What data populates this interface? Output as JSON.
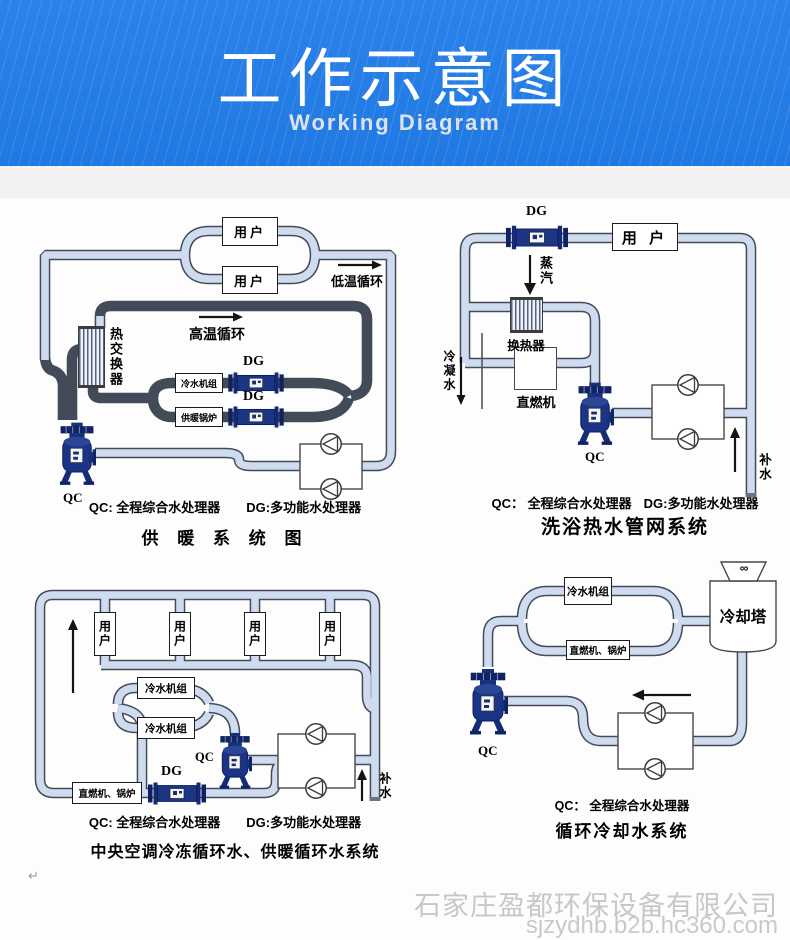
{
  "header": {
    "title": "工作示意图",
    "subtitle": "Working Diagram"
  },
  "colors": {
    "header_blue": "#2b82ea",
    "pipe_fill": "#cfdcf0",
    "pipe_outline": "#434b59",
    "device_navy": "#1b3488"
  },
  "d1": {
    "title": "供 暖 系 统 图",
    "legend_qc": "QC: 全程综合水处理器",
    "legend_dg": "DG:多功能水处理器",
    "labels": {
      "user1": "用户",
      "user2": "用户",
      "low_temp": "低温循环",
      "high_temp": "高温循环",
      "heat_exchanger": "热交换器",
      "chiller": "冷水机组",
      "boiler": "供暖锅炉",
      "dg1": "DG",
      "dg2": "DG",
      "qc": "QC"
    }
  },
  "d2": {
    "title": "洗浴热水管网系统",
    "legend_qc": "QC： 全程综合水处理器",
    "legend_dg": "DG:多功能水处理器",
    "labels": {
      "dg": "DG",
      "user": "用 户",
      "steam": "蒸汽",
      "exchanger": "换热器",
      "direct_fired": "直燃机",
      "condensate": "冷凝水",
      "qc": "QC",
      "makeup": "补水"
    }
  },
  "d3": {
    "title": "中央空调冷冻循环水、供暖循环水系统",
    "legend_qc": "QC: 全程综合水处理器",
    "legend_dg": "DG:多功能水处理器",
    "labels": {
      "users": [
        "用户",
        "用户",
        "用户",
        "用户"
      ],
      "chiller1": "冷水机组",
      "chiller2": "冷水机组",
      "boiler": "直燃机、锅炉",
      "dg": "DG",
      "qc": "QC",
      "makeup": "补水"
    }
  },
  "d4": {
    "title": "循环冷却水系统",
    "legend_qc": "QC： 全程综合水处理器",
    "labels": {
      "chiller": "冷水机组",
      "boiler": "直燃机、锅炉",
      "tower": "冷却塔",
      "fan": "∞",
      "qc": "QC"
    }
  },
  "watermark": {
    "company": "石家庄盈都环保设备有限公司",
    "url": "sjzydhb.b2b.hc360.com"
  },
  "artifact": {
    "mark": "↵"
  }
}
